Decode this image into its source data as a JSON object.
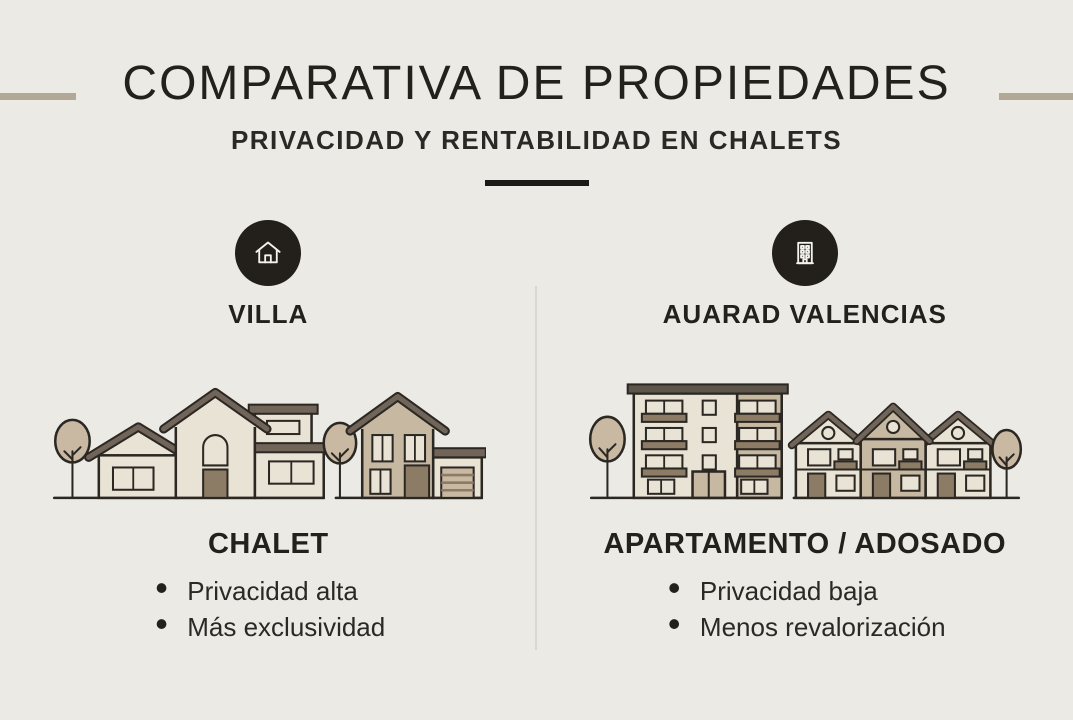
{
  "theme": {
    "background": "#ECEAE4",
    "ink": "#23211C",
    "muted_ink": "#2B2925",
    "accent_bar": "#B2A897",
    "divider_dark": "#1B1A17",
    "column_divider": "#D9D7D0",
    "icon_circle": "#23201B",
    "icon_glyph": "#F4F2EC",
    "wall_light": "#E9E3D6",
    "wall_tan": "#C7B8A2",
    "roof": "#71655A",
    "roof_dark": "#5E554A",
    "door_brown": "#8C7B65",
    "tree_fill": "#C9B9A3",
    "outline": "#2B2823"
  },
  "header": {
    "title": "COMPARATIVA DE PROPIEDADES",
    "subtitle": "PRIVACIDAD Y RENTABILIDAD EN CHALETS"
  },
  "columns": [
    {
      "id": "villa",
      "icon": "home-icon",
      "label": "VILLA",
      "heading": "CHALET",
      "bullets": [
        "Privacidad alta",
        "Más exclusividad"
      ]
    },
    {
      "id": "apartamento",
      "icon": "apartment-building-icon",
      "label": "AUARAD VALENCIAS",
      "heading": "APARTAMENTO / ADOSADO",
      "bullets": [
        "Privacidad baja",
        "Menos revalorización"
      ]
    }
  ]
}
